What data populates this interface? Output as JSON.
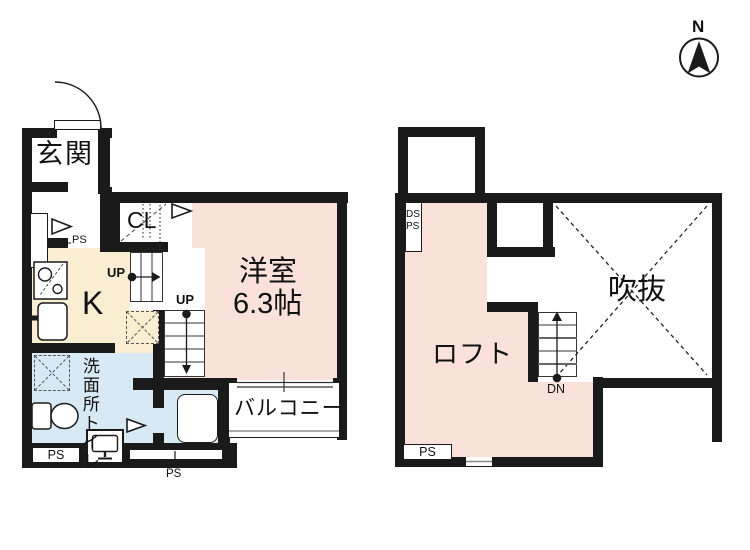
{
  "compass": {
    "north_label": "N"
  },
  "floor1": {
    "entrance_label": "玄関",
    "closet_label": "CL",
    "kitchen_label": "K",
    "room_name": "洋室",
    "room_size": "6.3帖",
    "washroom_label": "洗面所",
    "toilet_label": "トイレ",
    "balcony_label": "バルコニー",
    "stairs_up_label_1": "UP",
    "stairs_up_label_2": "UP",
    "ps_label_left": "PS",
    "ps_label_bottom_left": "PS",
    "ps_label_bottom_center": "PS"
  },
  "floor2": {
    "loft_label": "ロフト",
    "void_label": "吹抜",
    "stairs_down_label": "DN",
    "ds_label": "DS",
    "ps_label": "PS",
    "ps_label_bottom": "PS"
  },
  "colors": {
    "room_pink": "#fae2da",
    "kitchen_cream": "#f9eed2",
    "wet_blue": "#d8e9f6",
    "wall_black": "#1a1a1a"
  }
}
